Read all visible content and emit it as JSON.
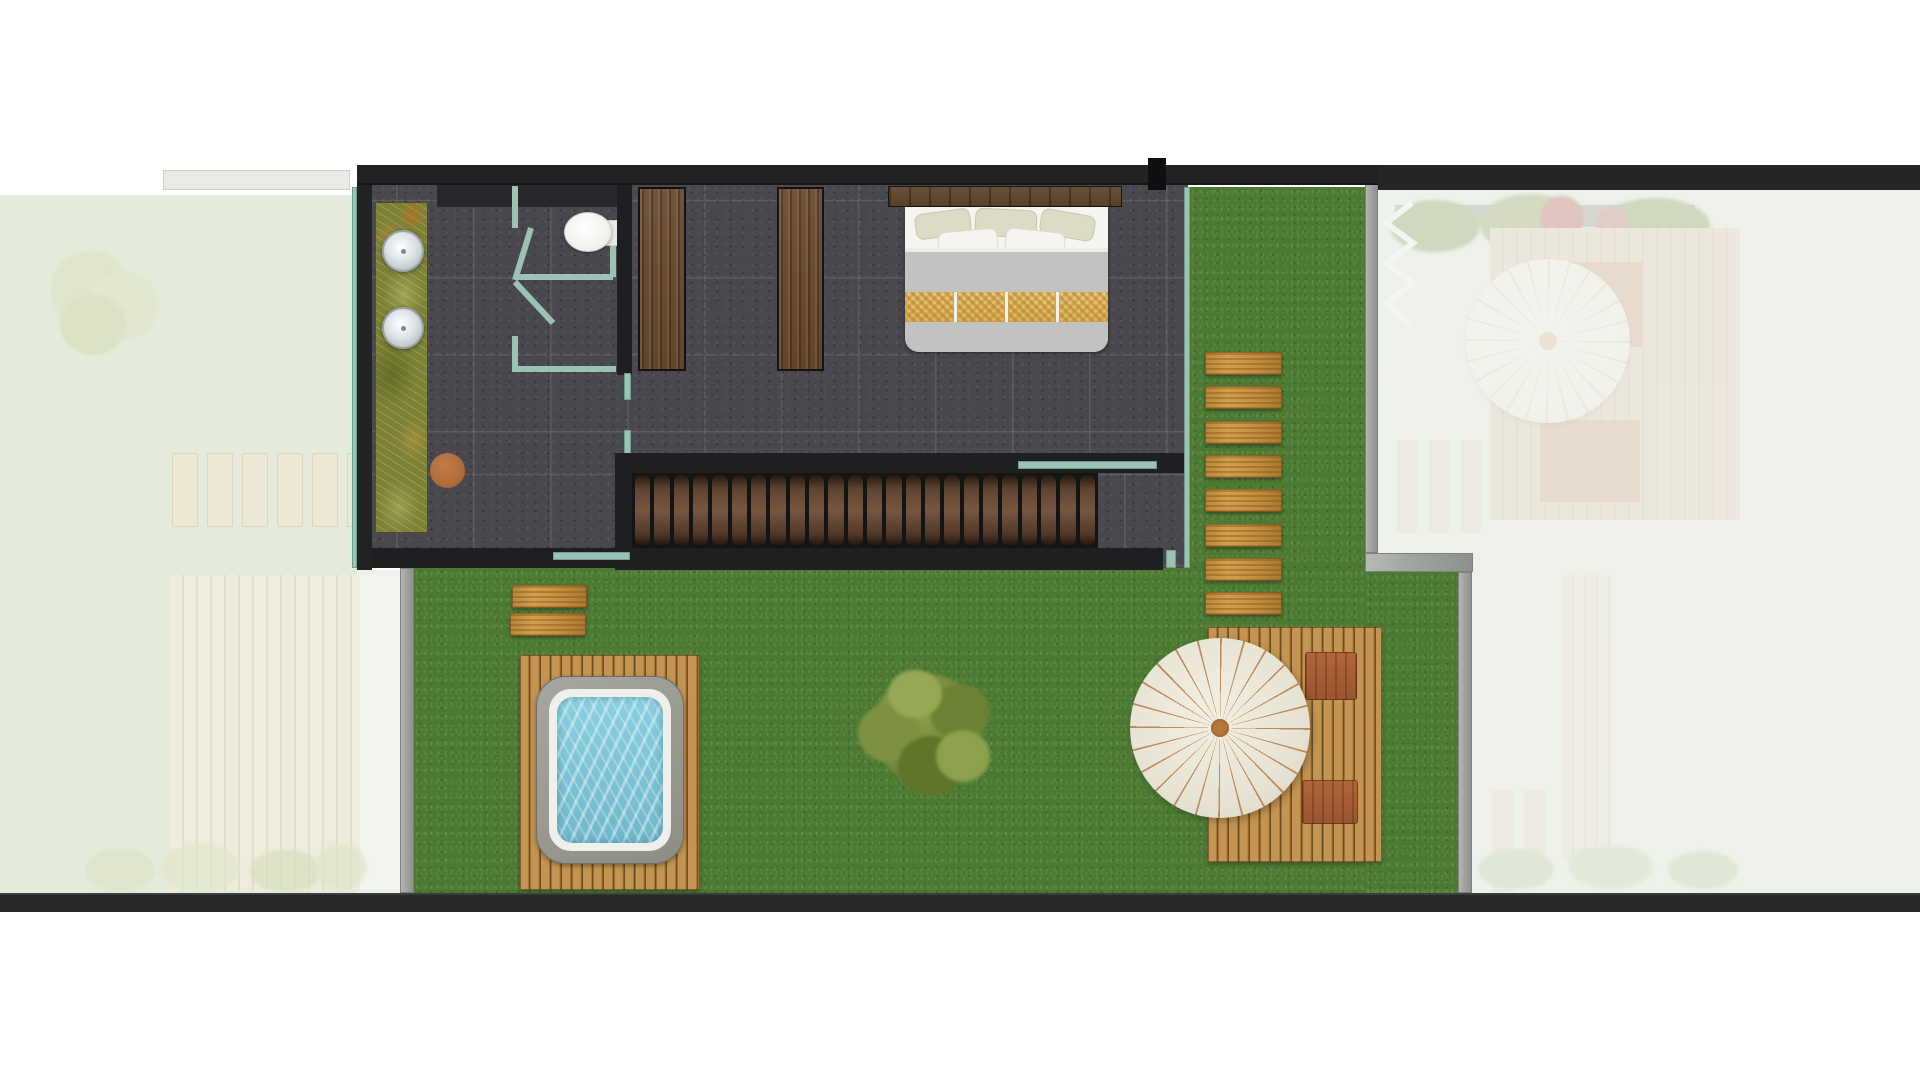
{
  "scene": {
    "type": "architectural-floor-plan",
    "view": "top-down",
    "active_unit": "center-villa-upper-floor-with-garden",
    "neighbor_units": [
      "left-faded",
      "right-faded"
    ],
    "rooms": [
      "bathroom-with-double-vanity-and-shower",
      "bedroom-with-double-bed-and-wardrobes",
      "staircase",
      "garden-with-hot-tub-tree-umbrella-deck"
    ]
  },
  "counts": {
    "stair_treads": 24,
    "umbrella_spokes": 24,
    "parasol_spokes": 24,
    "path_planks": 8,
    "left_unit_plank_row": 6,
    "right_unit_planks": 3,
    "garden_step_planks": 2,
    "vanity_sinks": 2,
    "wardrobes": 2,
    "deck_loungers": 2
  },
  "palette": {
    "wall": "#1d1f21",
    "bar": "#202224",
    "bar2": "#232527",
    "bottom": "#26282a",
    "floor": "#48484e",
    "teal": "#9cc2b4",
    "grass": "#4d7a33",
    "onyx": "#7c8136",
    "gold": "#c2913e",
    "deck": "#b98c48",
    "stairwood": "#5c4333",
    "wardrobe": "#6e4f35",
    "headboard": "#614834",
    "mattress": "#cbcbc9",
    "blanket": "#c2c2c0",
    "goldband": "#e3bd67",
    "pillow_white": "#f4f4f0",
    "pillow_khaki": "#dcdcc6",
    "water": "#7cc4d6",
    "tub_rim": "#efefeb",
    "tub_shell": "#96968f",
    "umbrella": "#e9e5d7",
    "spoke": "#bd8a5e",
    "umbrella_center": "#b5763c",
    "stool": "#b06c3c",
    "tree": "#74883a",
    "graywall": "#a3a6a3",
    "left_bg": "#e5ecdc",
    "right_bg": "#edf1ea"
  }
}
